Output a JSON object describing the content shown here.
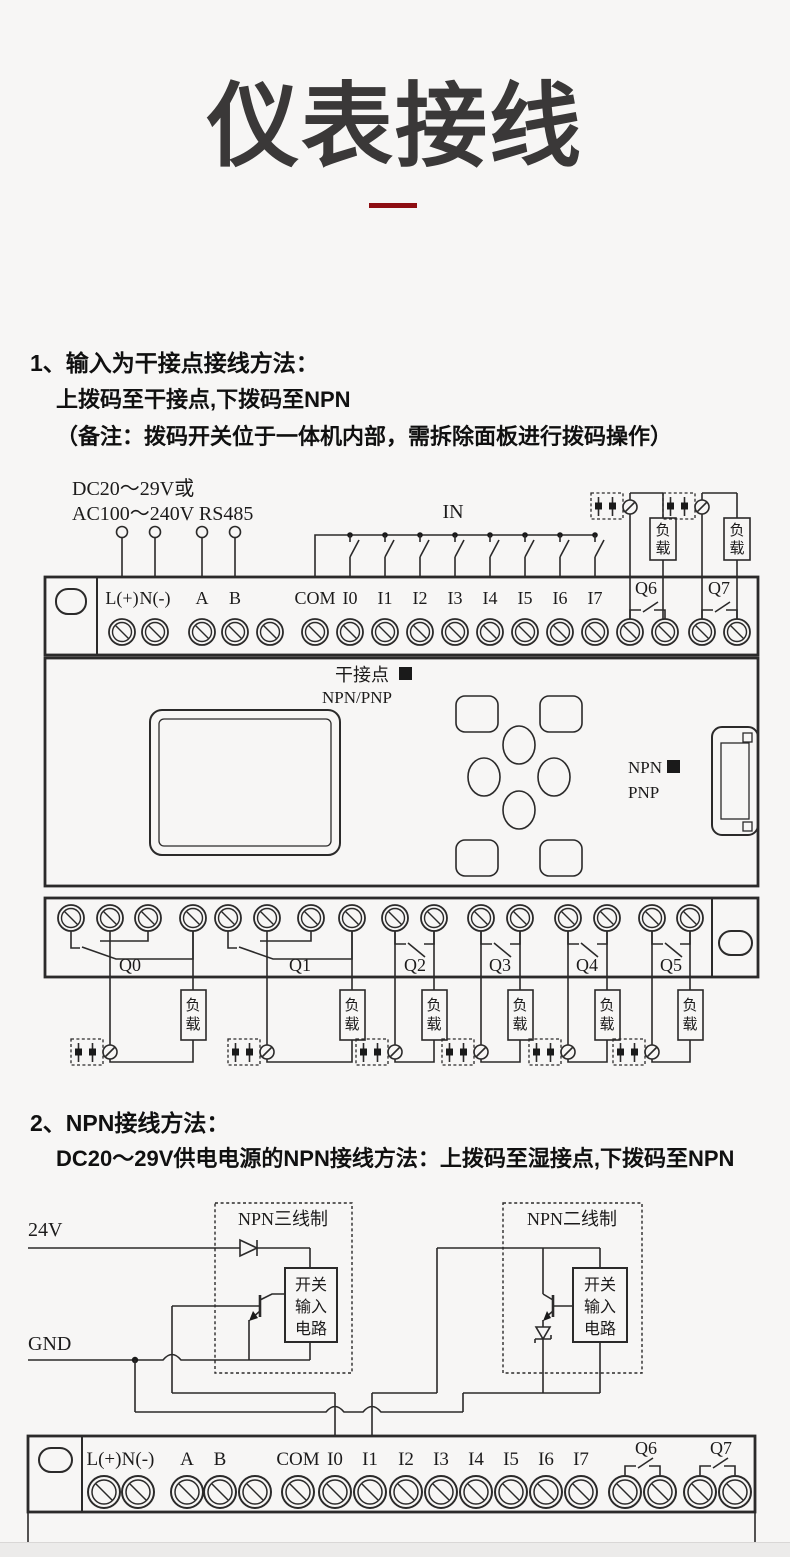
{
  "page": {
    "title": "仪表接线",
    "section1_heading": "1、输入为干接点接线方法：",
    "section1_line1": "上拨码至干接点,下拨码至NPN",
    "section1_note": "（备注：拨码开关位于一体机内部，需拆除面板进行拨码操作）",
    "section2_heading": "2、NPN接线方法：",
    "section2_line1": "DC20～29V供电电源的NPN接线方法：上拨码至湿接点,下拨码至NPN"
  },
  "colors": {
    "accent": "#8e0e12",
    "ink": "#2b2a2a",
    "background": "#f7f6f5"
  },
  "diagram1": {
    "power_dc": "DC20～29V或",
    "power_ac": "AC100～240V  RS485",
    "in_label": "IN",
    "dip_dry": "干接点",
    "dip_dry_modes": "NPN/PNP",
    "dip_npn": "NPN",
    "dip_pnp": "PNP"
  },
  "terminals": [
    "L(+)",
    "N(-)",
    "A",
    "B",
    "COM",
    "I0",
    "I1",
    "I2",
    "I3",
    "I4",
    "I5",
    "I6",
    "I7"
  ],
  "relays_top": [
    "Q6",
    "Q7"
  ],
  "relays_bottom": [
    "Q0",
    "Q1",
    "Q2",
    "Q3",
    "Q4",
    "Q5"
  ],
  "load": {
    "c1": "负",
    "c2": "载"
  },
  "diagram2": {
    "v24": "24V",
    "gnd": "GND",
    "sensor3": "NPN三线制",
    "sensor2": "NPN二线制",
    "circuit_l1": "开关",
    "circuit_l2": "输入",
    "circuit_l3": "电路"
  }
}
